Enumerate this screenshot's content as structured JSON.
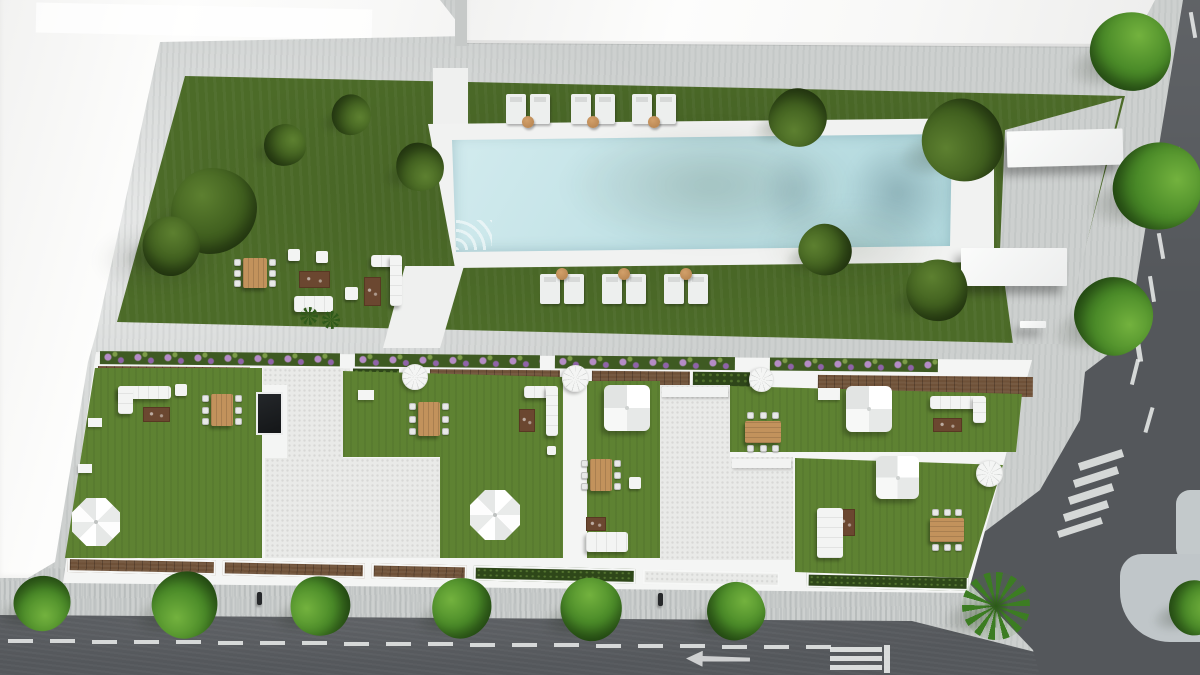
{
  "summary": {
    "view": "top-down aerial 3D architectural render",
    "site": "Aerial render of a residential block: rooftop terraces with lawns and outdoor furniture, a communal garden with rectangular swimming pool, sun loungers, trees, and surrounding streets with road markings",
    "pool": {
      "shape": "rectangular",
      "water_color": "#c3e2e6",
      "deck_color": "#f1f2f1"
    },
    "sun_lounger_pairs": 6,
    "rooftop_terraces": 5,
    "garden_trees": 9,
    "street_trees": 10,
    "palm_trees": 1
  },
  "palette": {
    "pavement": "#cdd0cf",
    "sidewalk": "#b6bdc1",
    "asphalt": "#54575b",
    "building": "#fafbfa",
    "grass_garden": "#4c6b28",
    "grass_terrace": "#5e8232",
    "hedge": "#2e4719",
    "pool_water": "#c3e2e6",
    "pool_deck": "#f1f2f1",
    "wood_deck": "#6f5138",
    "wood_table": "#c2925c",
    "gravel": "#e9eae8",
    "white_furniture": "#f2f3f2",
    "flower": "#b184c2",
    "marking": "#eceeed"
  },
  "scene": {
    "trees": [
      {
        "kind": "garden",
        "x": 214,
        "y": 211,
        "r": 43
      },
      {
        "kind": "garden",
        "x": 171,
        "y": 246,
        "r": 29
      },
      {
        "kind": "garden",
        "x": 285,
        "y": 145,
        "r": 21
      },
      {
        "kind": "garden",
        "x": 351,
        "y": 115,
        "r": 20
      },
      {
        "kind": "garden",
        "x": 420,
        "y": 167,
        "r": 24
      },
      {
        "kind": "garden",
        "x": 798,
        "y": 118,
        "r": 29
      },
      {
        "kind": "garden",
        "x": 963,
        "y": 140,
        "r": 41
      },
      {
        "kind": "garden",
        "x": 825,
        "y": 250,
        "r": 26
      },
      {
        "kind": "garden",
        "x": 937,
        "y": 290,
        "r": 31
      },
      {
        "kind": "street",
        "x": 1131,
        "y": 52,
        "r": 40
      },
      {
        "kind": "street",
        "x": 1158,
        "y": 186,
        "r": 44
      },
      {
        "kind": "street",
        "x": 1114,
        "y": 316,
        "r": 39
      },
      {
        "kind": "street",
        "x": 42,
        "y": 603,
        "r": 28
      },
      {
        "kind": "street",
        "x": 185,
        "y": 605,
        "r": 33
      },
      {
        "kind": "street",
        "x": 320,
        "y": 606,
        "r": 30
      },
      {
        "kind": "street",
        "x": 462,
        "y": 608,
        "r": 30
      },
      {
        "kind": "street",
        "x": 591,
        "y": 609,
        "r": 31
      },
      {
        "kind": "street",
        "x": 736,
        "y": 611,
        "r": 29
      },
      {
        "kind": "street",
        "x": 1195,
        "y": 608,
        "r": 27
      },
      {
        "kind": "palm",
        "x": 996,
        "y": 606,
        "r": 34
      }
    ],
    "lounger_pairs": [
      {
        "x": 506,
        "y": 94,
        "table": "bottom"
      },
      {
        "x": 571,
        "y": 94,
        "table": "bottom"
      },
      {
        "x": 632,
        "y": 94,
        "table": "bottom"
      },
      {
        "x": 540,
        "y": 274,
        "table": "top"
      },
      {
        "x": 602,
        "y": 274,
        "table": "top"
      },
      {
        "x": 664,
        "y": 274,
        "table": "top"
      }
    ],
    "dining_sets": [
      {
        "x": 243,
        "y": 258,
        "w": 24,
        "h": 30,
        "o": "v"
      },
      {
        "x": 211,
        "y": 394,
        "w": 22,
        "h": 32,
        "o": "v"
      },
      {
        "x": 418,
        "y": 402,
        "w": 22,
        "h": 34,
        "o": "v"
      },
      {
        "x": 590,
        "y": 459,
        "w": 22,
        "h": 32,
        "o": "v"
      },
      {
        "x": 745,
        "y": 421,
        "w": 36,
        "h": 22,
        "o": "h"
      },
      {
        "x": 930,
        "y": 518,
        "w": 34,
        "h": 24,
        "o": "h"
      }
    ],
    "rugs": [
      {
        "x": 299,
        "y": 271,
        "w": 31,
        "h": 17
      },
      {
        "x": 364,
        "y": 277,
        "w": 17,
        "h": 29
      },
      {
        "x": 143,
        "y": 407,
        "w": 27,
        "h": 15
      },
      {
        "x": 519,
        "y": 409,
        "w": 16,
        "h": 23
      },
      {
        "x": 586,
        "y": 517,
        "w": 20,
        "h": 14
      },
      {
        "x": 933,
        "y": 418,
        "w": 29,
        "h": 14
      },
      {
        "x": 838,
        "y": 509,
        "w": 17,
        "h": 27
      }
    ],
    "cubes": [
      {
        "x": 288,
        "y": 249,
        "s": 12
      },
      {
        "x": 316,
        "y": 251,
        "s": 12
      },
      {
        "x": 345,
        "y": 287,
        "s": 13
      },
      {
        "x": 175,
        "y": 384,
        "s": 12
      },
      {
        "x": 547,
        "y": 446,
        "s": 9
      },
      {
        "x": 629,
        "y": 477,
        "s": 12
      }
    ],
    "sofas": [
      {
        "bars": [
          [
            294,
            296,
            39,
            16
          ]
        ]
      },
      {
        "bars": [
          [
            371,
            255,
            31,
            12
          ],
          [
            390,
            255,
            12,
            51
          ]
        ]
      },
      {
        "bars": [
          [
            118,
            386,
            53,
            13
          ],
          [
            118,
            386,
            15,
            28
          ]
        ]
      },
      {
        "bars": [
          [
            524,
            386,
            34,
            12
          ],
          [
            546,
            386,
            12,
            50
          ]
        ]
      },
      {
        "bars": [
          [
            586,
            532,
            42,
            20
          ]
        ]
      },
      {
        "bars": [
          [
            930,
            396,
            56,
            13
          ],
          [
            973,
            396,
            13,
            27
          ]
        ]
      },
      {
        "bars": [
          [
            817,
            508,
            26,
            50
          ]
        ]
      }
    ],
    "umbrellas": [
      {
        "x": 72,
        "y": 498,
        "d": 48
      },
      {
        "x": 470,
        "y": 490,
        "d": 50
      }
    ],
    "tents": [
      {
        "x": 604,
        "y": 385,
        "s": 46
      },
      {
        "x": 846,
        "y": 386,
        "s": 46
      },
      {
        "x": 876,
        "y": 456,
        "s": 43
      }
    ],
    "spiral_stairs": [
      {
        "x": 402,
        "y": 364,
        "d": 26
      },
      {
        "x": 562,
        "y": 365,
        "d": 27
      },
      {
        "x": 749,
        "y": 367,
        "d": 25
      },
      {
        "x": 976,
        "y": 460,
        "d": 27
      }
    ],
    "slabs": [
      {
        "x": 1007,
        "y": 130,
        "w": 116,
        "h": 36,
        "rot": -1.5
      },
      {
        "x": 961,
        "y": 248,
        "w": 106,
        "h": 38,
        "rot": 0
      },
      {
        "x": 1020,
        "y": 321,
        "w": 26,
        "h": 7,
        "rot": 0
      }
    ],
    "skylights": [
      {
        "x": 256,
        "y": 392,
        "w": 27,
        "h": 43
      }
    ],
    "palm_shrubs": [
      {
        "x": 309,
        "y": 316,
        "r": 9
      },
      {
        "x": 331,
        "y": 320,
        "r": 9
      }
    ],
    "posts": [
      {
        "x": 257,
        "y": 592
      },
      {
        "x": 658,
        "y": 593
      }
    ],
    "white_boxes": [
      {
        "x": 88,
        "y": 418,
        "w": 14,
        "h": 9
      },
      {
        "x": 78,
        "y": 464,
        "w": 14,
        "h": 9
      },
      {
        "x": 818,
        "y": 388,
        "w": 22,
        "h": 12
      },
      {
        "x": 358,
        "y": 390,
        "w": 16,
        "h": 10
      }
    ],
    "road_markings": {
      "bottom_dashes": {
        "x0": 8,
        "count": 20,
        "step": 42,
        "w": 25,
        "h": 4,
        "y": 639
      },
      "bottom_arrow": {
        "x": 686,
        "y": 651,
        "w": 64,
        "h": 16,
        "dir": "left"
      },
      "stop_bars": [
        {
          "x": 830,
          "y": 647,
          "w": 52,
          "h": 5
        },
        {
          "x": 830,
          "y": 656,
          "w": 52,
          "h": 5
        },
        {
          "x": 830,
          "y": 665,
          "w": 52,
          "h": 5
        },
        {
          "x": 884,
          "y": 645,
          "w": 6,
          "h": 28
        }
      ],
      "right_dashes": [
        [
          1193,
          25,
          -10
        ],
        [
          1180,
          160,
          -10
        ],
        [
          1170,
          203,
          -10
        ],
        [
          1161,
          246,
          -10
        ],
        [
          1152,
          289,
          -9
        ],
        [
          1135,
          372,
          14
        ],
        [
          1149,
          420,
          16
        ]
      ],
      "up_arrow": {
        "x": 1130,
        "y": 328,
        "w": 16,
        "h": 34,
        "rot": -9
      },
      "crosswalk_stripes": [
        [
          1101,
          460
        ],
        [
          1096,
          477
        ],
        [
          1091,
          494
        ],
        [
          1086,
          511
        ]
      ],
      "crosswalk_rot": -18,
      "stop_line": {
        "x": 1080,
        "y": 527,
        "w": 46,
        "h": 7,
        "rot": -18
      }
    }
  }
}
